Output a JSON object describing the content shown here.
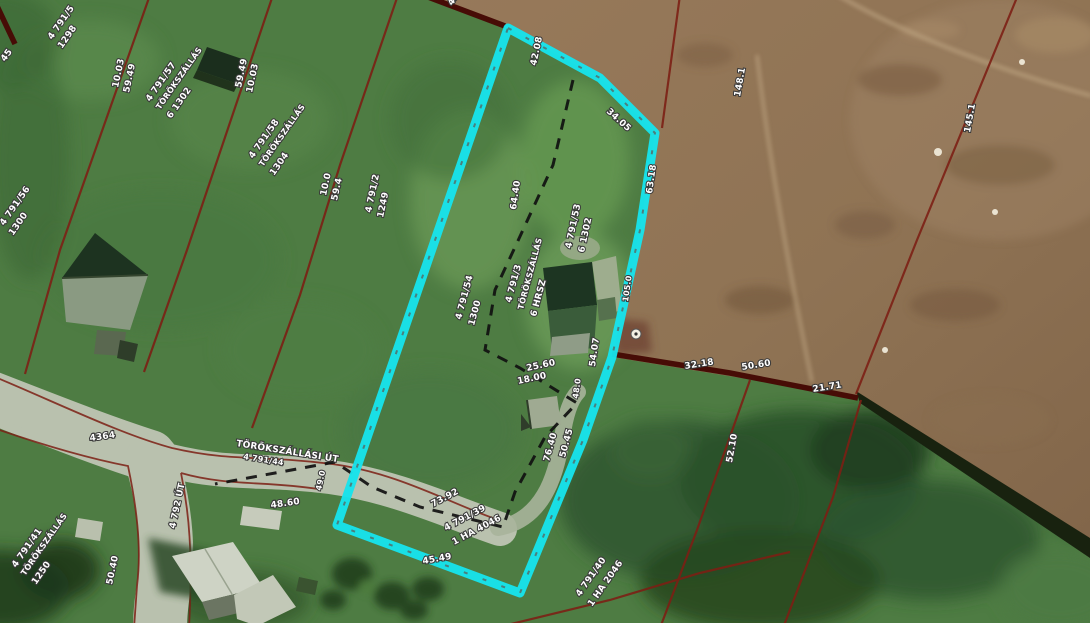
{
  "map": {
    "description": "Aerial cadastral map with parcel boundaries and one highlighted parcel",
    "colors": {
      "highlight_parcel": "#17e3ec",
      "parcel_line": "#7c2015",
      "parcel_line_thick": "#470c06",
      "inner_boundary_dash": "#101010",
      "label_text": "#ffffff",
      "grass": "#4e7c43",
      "bare_soil": "#8f7354",
      "road": "#b9c1ae"
    },
    "labels": [
      {
        "text": "45",
        "x": 5,
        "y": 62,
        "rot": -55,
        "size": 9
      },
      {
        "text": "4 791/5",
        "x": 52,
        "y": 40,
        "rot": -55,
        "size": 9
      },
      {
        "text": "1298",
        "x": 62,
        "y": 49,
        "rot": -55,
        "size": 9
      },
      {
        "text": "456",
        "x": 452,
        "y": 6,
        "rot": -55,
        "size": 9
      },
      {
        "text": "10.03",
        "x": 118,
        "y": 88,
        "rot": -78,
        "size": 9
      },
      {
        "text": "59.49",
        "x": 129,
        "y": 93,
        "rot": -78,
        "size": 9
      },
      {
        "text": "59.49",
        "x": 241,
        "y": 88,
        "rot": -78,
        "size": 9
      },
      {
        "text": "10.03",
        "x": 252,
        "y": 93,
        "rot": -78,
        "size": 9
      },
      {
        "text": "4 791/57",
        "x": 150,
        "y": 102,
        "rot": -55,
        "size": 9
      },
      {
        "text": "TÖRÖKSZÁLLÁS",
        "x": 160,
        "y": 110,
        "rot": -55,
        "size": 8
      },
      {
        "text": "6 1302",
        "x": 171,
        "y": 119,
        "rot": -55,
        "size": 9
      },
      {
        "text": "4 791/58",
        "x": 253,
        "y": 159,
        "rot": -55,
        "size": 9
      },
      {
        "text": "TÖRÖKSZÁLLÁS",
        "x": 263,
        "y": 167,
        "rot": -55,
        "size": 8
      },
      {
        "text": "1304",
        "x": 274,
        "y": 176,
        "rot": -55,
        "size": 9
      },
      {
        "text": "4 791/56",
        "x": 4,
        "y": 226,
        "rot": -55,
        "size": 9
      },
      {
        "text": "1300",
        "x": 13,
        "y": 236,
        "rot": -55,
        "size": 9
      },
      {
        "text": "42.08",
        "x": 536,
        "y": 66,
        "rot": -78,
        "size": 9
      },
      {
        "text": "34.05",
        "x": 606,
        "y": 112,
        "rot": 42,
        "size": 9
      },
      {
        "text": "148.1",
        "x": 740,
        "y": 97,
        "rot": -80,
        "size": 9
      },
      {
        "text": "145.1",
        "x": 970,
        "y": 133,
        "rot": -80,
        "size": 9
      },
      {
        "text": "10.0",
        "x": 326,
        "y": 196,
        "rot": -78,
        "size": 9
      },
      {
        "text": "59.4",
        "x": 337,
        "y": 201,
        "rot": -78,
        "size": 9
      },
      {
        "text": "4 791/2",
        "x": 371,
        "y": 213,
        "rot": -78,
        "size": 9
      },
      {
        "text": "1249",
        "x": 383,
        "y": 218,
        "rot": -78,
        "size": 9
      },
      {
        "text": "64.40",
        "x": 516,
        "y": 210,
        "rot": -82,
        "size": 9
      },
      {
        "text": "63.18",
        "x": 652,
        "y": 194,
        "rot": -82,
        "size": 9
      },
      {
        "text": "4 791/53",
        "x": 571,
        "y": 249,
        "rot": -78,
        "size": 9
      },
      {
        "text": "6 1302",
        "x": 584,
        "y": 253,
        "rot": -78,
        "size": 9
      },
      {
        "text": "105.0",
        "x": 628,
        "y": 302,
        "rot": -82,
        "size": 8
      },
      {
        "text": "4 791/54",
        "x": 461,
        "y": 320,
        "rot": -75,
        "size": 9
      },
      {
        "text": "1300",
        "x": 474,
        "y": 326,
        "rot": -75,
        "size": 9
      },
      {
        "text": "4 791/3",
        "x": 511,
        "y": 303,
        "rot": -75,
        "size": 9
      },
      {
        "text": "TÖRÖKSZÁLLÁS",
        "x": 523,
        "y": 310,
        "rot": -75,
        "size": 8
      },
      {
        "text": "6 HRSZ",
        "x": 536,
        "y": 317,
        "rot": -75,
        "size": 9
      },
      {
        "text": "25.60",
        "x": 527,
        "y": 371,
        "rot": -12,
        "size": 9
      },
      {
        "text": "18.00",
        "x": 518,
        "y": 384,
        "rot": -12,
        "size": 9
      },
      {
        "text": "54.07",
        "x": 595,
        "y": 367,
        "rot": -82,
        "size": 9
      },
      {
        "text": "48.0",
        "x": 578,
        "y": 399,
        "rot": -82,
        "size": 8
      },
      {
        "text": "32.18",
        "x": 685,
        "y": 369,
        "rot": -9,
        "size": 9
      },
      {
        "text": "50.60",
        "x": 742,
        "y": 370,
        "rot": -9,
        "size": 9
      },
      {
        "text": "21.71",
        "x": 813,
        "y": 392,
        "rot": -9,
        "size": 9
      },
      {
        "text": "52.10",
        "x": 732,
        "y": 463,
        "rot": -80,
        "size": 9
      },
      {
        "text": "TÖRÖKSZÁLLÁSI ÚT",
        "x": 236,
        "y": 446,
        "rot": 9,
        "size": 9
      },
      {
        "text": "4 791/44",
        "x": 243,
        "y": 459,
        "rot": 9,
        "size": 8
      },
      {
        "text": "4364",
        "x": 90,
        "y": 441,
        "rot": -8,
        "size": 9
      },
      {
        "text": "48.60",
        "x": 271,
        "y": 508,
        "rot": -8,
        "size": 9
      },
      {
        "text": "4 792 ÚT",
        "x": 175,
        "y": 529,
        "rot": -78,
        "size": 9
      },
      {
        "text": "50.40",
        "x": 112,
        "y": 585,
        "rot": -78,
        "size": 9
      },
      {
        "text": "4 791/41",
        "x": 16,
        "y": 568,
        "rot": -55,
        "size": 9
      },
      {
        "text": "TÖRÖKSZÁLLÁS",
        "x": 25,
        "y": 576,
        "rot": -55,
        "size": 8
      },
      {
        "text": "1250",
        "x": 36,
        "y": 585,
        "rot": -55,
        "size": 9
      },
      {
        "text": "73.92",
        "x": 433,
        "y": 507,
        "rot": -28,
        "size": 9
      },
      {
        "text": "4 791/39",
        "x": 446,
        "y": 531,
        "rot": -28,
        "size": 9
      },
      {
        "text": "1 HA 4046",
        "x": 454,
        "y": 545,
        "rot": -28,
        "size": 9
      },
      {
        "text": "45.49",
        "x": 423,
        "y": 564,
        "rot": -10,
        "size": 9
      },
      {
        "text": "49.0",
        "x": 321,
        "y": 491,
        "rot": -78,
        "size": 8
      },
      {
        "text": "76.40",
        "x": 549,
        "y": 462,
        "rot": -75,
        "size": 9
      },
      {
        "text": "50.45",
        "x": 565,
        "y": 458,
        "rot": -75,
        "size": 9
      },
      {
        "text": "4 791/40",
        "x": 580,
        "y": 597,
        "rot": -55,
        "size": 9
      },
      {
        "text": "1 HA 2046",
        "x": 592,
        "y": 607,
        "rot": -55,
        "size": 9
      }
    ],
    "symbols": [
      {
        "type": "survey-point",
        "x": 636,
        "y": 334
      }
    ]
  }
}
